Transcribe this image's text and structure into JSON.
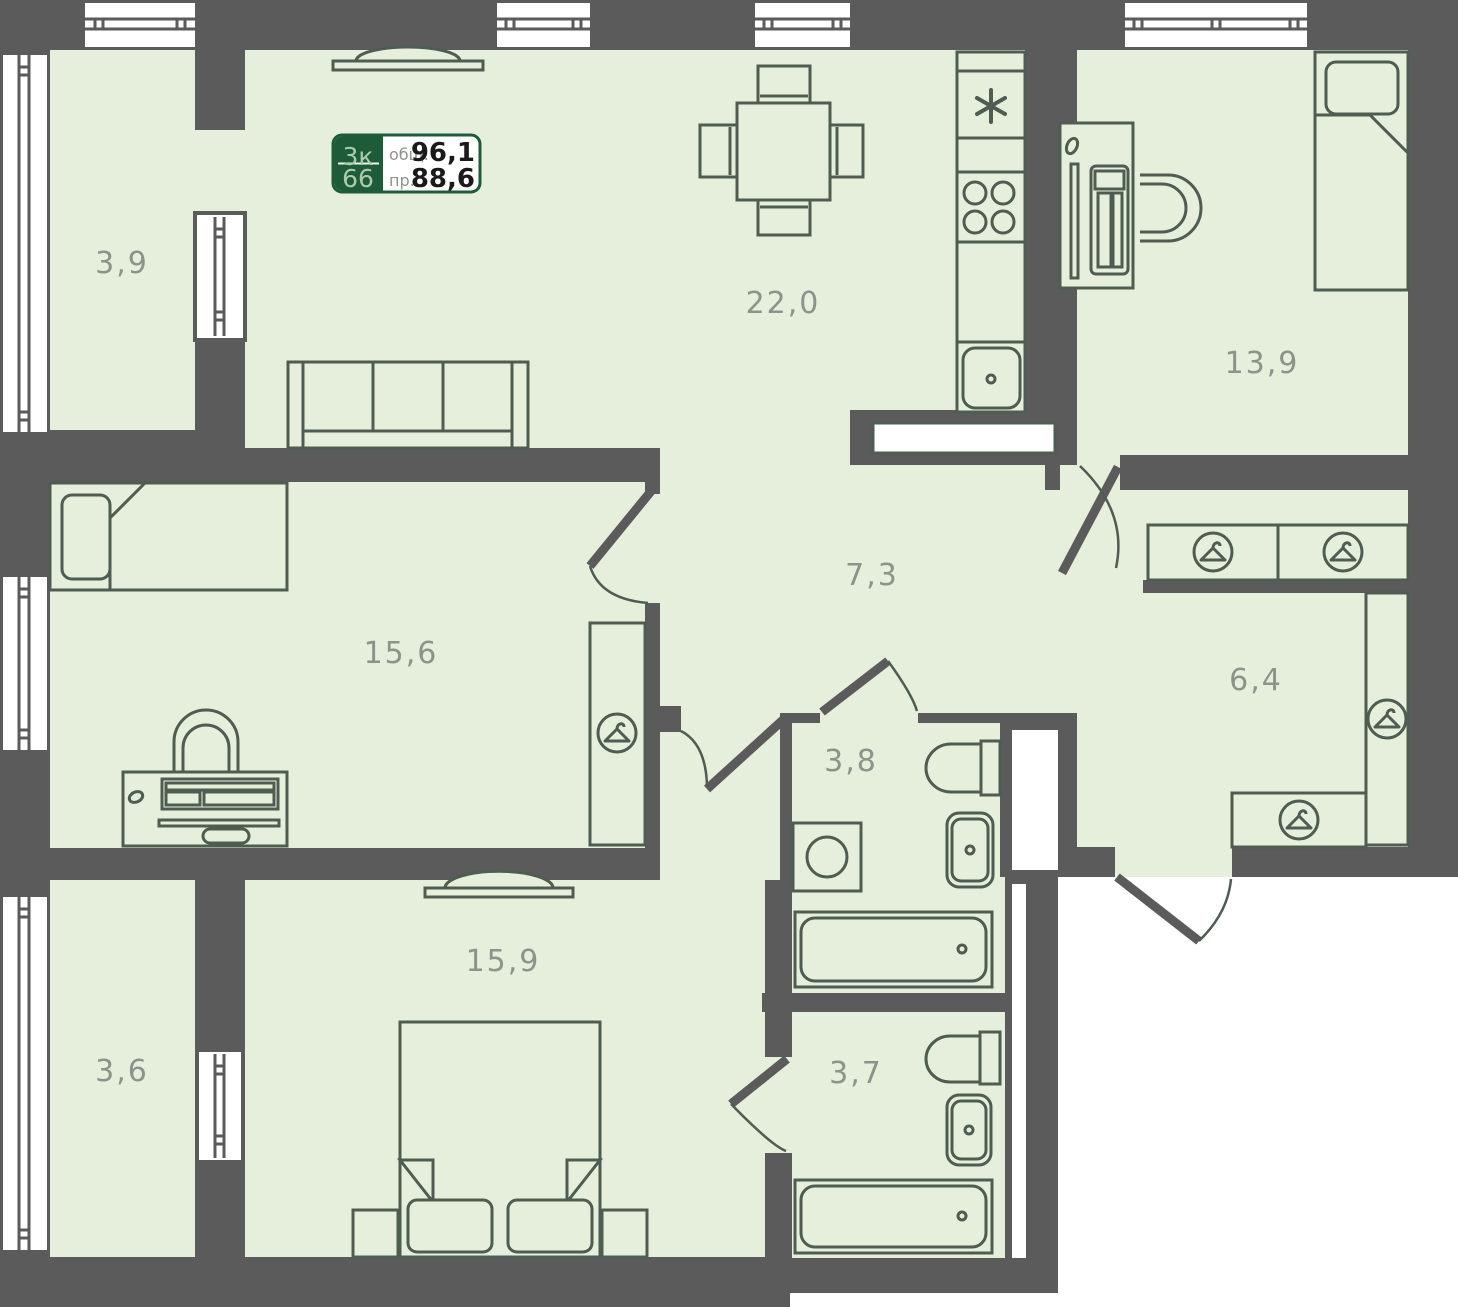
{
  "badge": {
    "type": "3к",
    "unit": "66",
    "total_label": "общ.",
    "total_value": "96,1",
    "reduced_label": "пр.",
    "reduced_value": "88,6"
  },
  "rooms": {
    "balcony_top": {
      "label": "3,9"
    },
    "living_kitchen": {
      "label": "22,0"
    },
    "bedroom_right": {
      "label": "13,9"
    },
    "bedroom_left": {
      "label": "15,6"
    },
    "hall_center": {
      "label": "7,3"
    },
    "hall_right": {
      "label": "6,4"
    },
    "bathroom_center": {
      "label": "3,8"
    },
    "bedroom_bottom": {
      "label": "15,9"
    },
    "balcony_bottom": {
      "label": "3,6"
    },
    "bathroom_bottom": {
      "label": "3,7"
    }
  },
  "colors": {
    "wall": "#5b5b5b",
    "floor": "#e5efdc",
    "line": "#4e5c51",
    "label": "#8b938b",
    "badge_green": "#1d5b39",
    "badge_light": "#abcbad",
    "white": "#ffffff",
    "number": "#1a1a1a"
  }
}
